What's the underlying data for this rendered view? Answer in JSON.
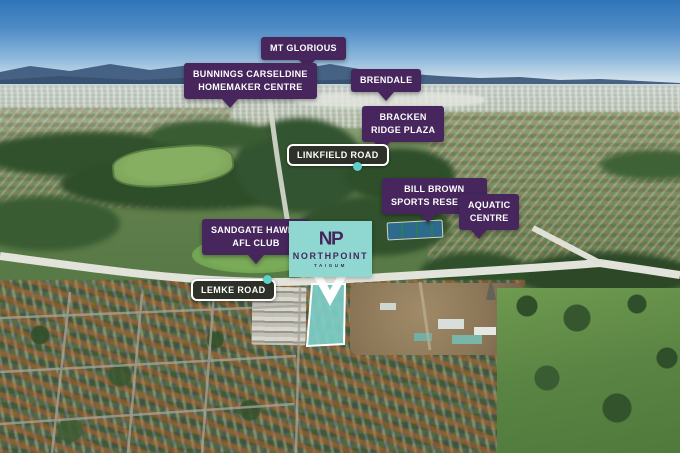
{
  "colors": {
    "label_purple": "#46265c",
    "logo_teal": "#8fd8d1",
    "site_teal": "#7cd3cc",
    "marker_teal": "#5fd0c6",
    "road_label_bg": "#2d3128"
  },
  "logo": {
    "monogram": "NP",
    "name": "NORTHPOINT",
    "suburb": "TAIGUM"
  },
  "place_labels": [
    {
      "id": "mt-glorious",
      "lines": [
        "MT GLORIOUS"
      ]
    },
    {
      "id": "bunnings-carseldine",
      "lines": [
        "BUNNINGS CARSELDINE",
        "HOMEMAKER CENTRE"
      ]
    },
    {
      "id": "brendale",
      "lines": [
        "BRENDALE"
      ]
    },
    {
      "id": "bracken-ridge-plaza",
      "lines": [
        "BRACKEN",
        "RIDGE PLAZA"
      ]
    },
    {
      "id": "bill-brown-reserve",
      "lines": [
        "BILL BROWN",
        "SPORTS RESERVE"
      ]
    },
    {
      "id": "aquatic-centre",
      "lines": [
        "AQUATIC",
        "CENTRE"
      ]
    },
    {
      "id": "sandgate-hawks",
      "lines": [
        "SANDGATE HAWKS",
        "AFL CLUB"
      ]
    }
  ],
  "road_labels": [
    {
      "id": "linkfield-road",
      "text": "LINKFIELD ROAD"
    },
    {
      "id": "lemke-road",
      "text": "LEMKE ROAD"
    }
  ]
}
